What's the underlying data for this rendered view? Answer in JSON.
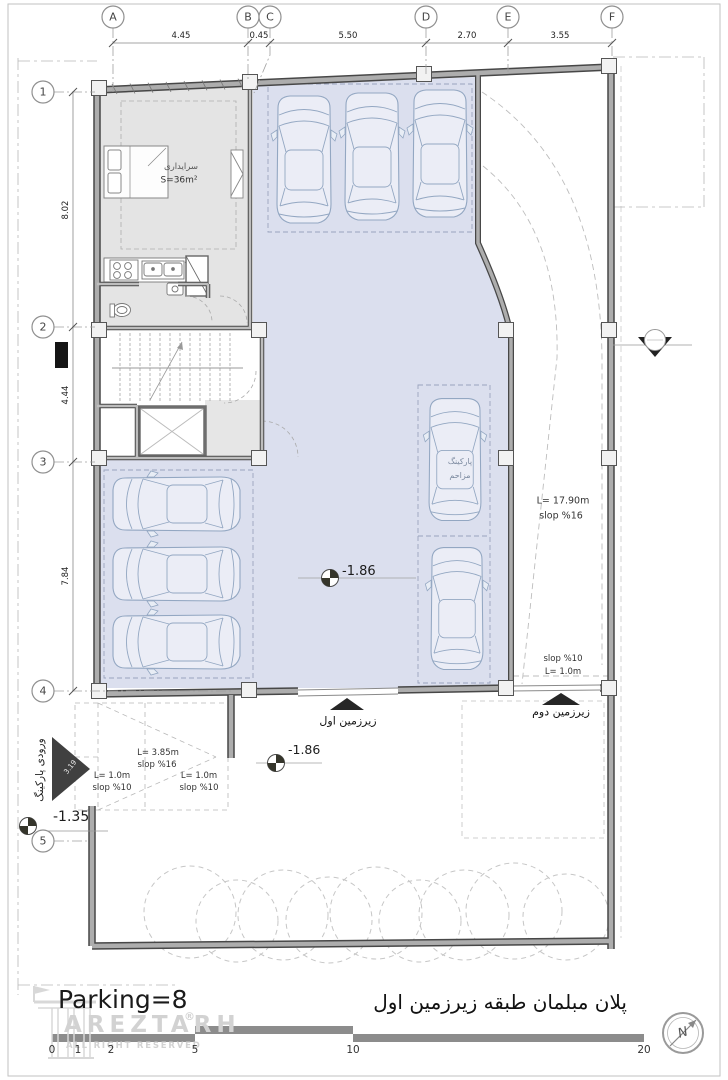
{
  "footer": {
    "parking_count": "Parking=8",
    "title_fa": "پلان مبلمان طبقه زیرزمین اول",
    "north": "N",
    "scale_ticks": [
      "0",
      "1",
      "2",
      "5",
      "10",
      "20"
    ]
  },
  "watermark": {
    "brand": "AREZTARH",
    "reg": "®",
    "rights": "ALL RIGHT RESERVED"
  },
  "grid": {
    "cols": {
      "a": "A",
      "b": "B",
      "c": "C",
      "d": "D",
      "e": "E",
      "f": "F"
    },
    "col_dims": {
      "ab": "4.45",
      "bc": "0.45",
      "cd": "5.50",
      "de": "2.70",
      "ef": "3.55"
    },
    "rows": {
      "r1": "1",
      "r2": "2",
      "r3": "3",
      "r4": "4",
      "r5": "5"
    },
    "row_dims": {
      "d12": "8.02",
      "d23": "4.44",
      "d34": "7.84"
    }
  },
  "room": {
    "name": "سرایداری",
    "area": "S=36m²"
  },
  "levels": {
    "parking": "-1.86",
    "yard": "-1.86",
    "entry": "-1.35"
  },
  "ramps": {
    "main_length": "L= 17.90m",
    "main_slope": "slop %16",
    "exit2_slope": "slop %10",
    "exit2_length": "L= 1.0m",
    "entry_mid_length": "L= 3.85m",
    "entry_mid_slope": "slop %16",
    "entry_a_length": "L= 1.0m",
    "entry_a_slope": "slop %10",
    "entry_b_length": "L= 1.0m",
    "entry_b_slope": "slop %10",
    "entry_arrow_length": "3.19"
  },
  "arrows": {
    "basement1": "زیرزمین اول",
    "basement2": "زیرزمین دوم",
    "entrance": "ورودی پارکینگ"
  },
  "stall_note": {
    "line1": "پارکینگ",
    "line2": "مزاحم"
  },
  "colors": {
    "parking_fill": "#dbdfee",
    "room_fill": "#e4e4e4",
    "wall": "#adadad",
    "wall_edge": "#474747",
    "car_stroke": "#93a7c2"
  }
}
